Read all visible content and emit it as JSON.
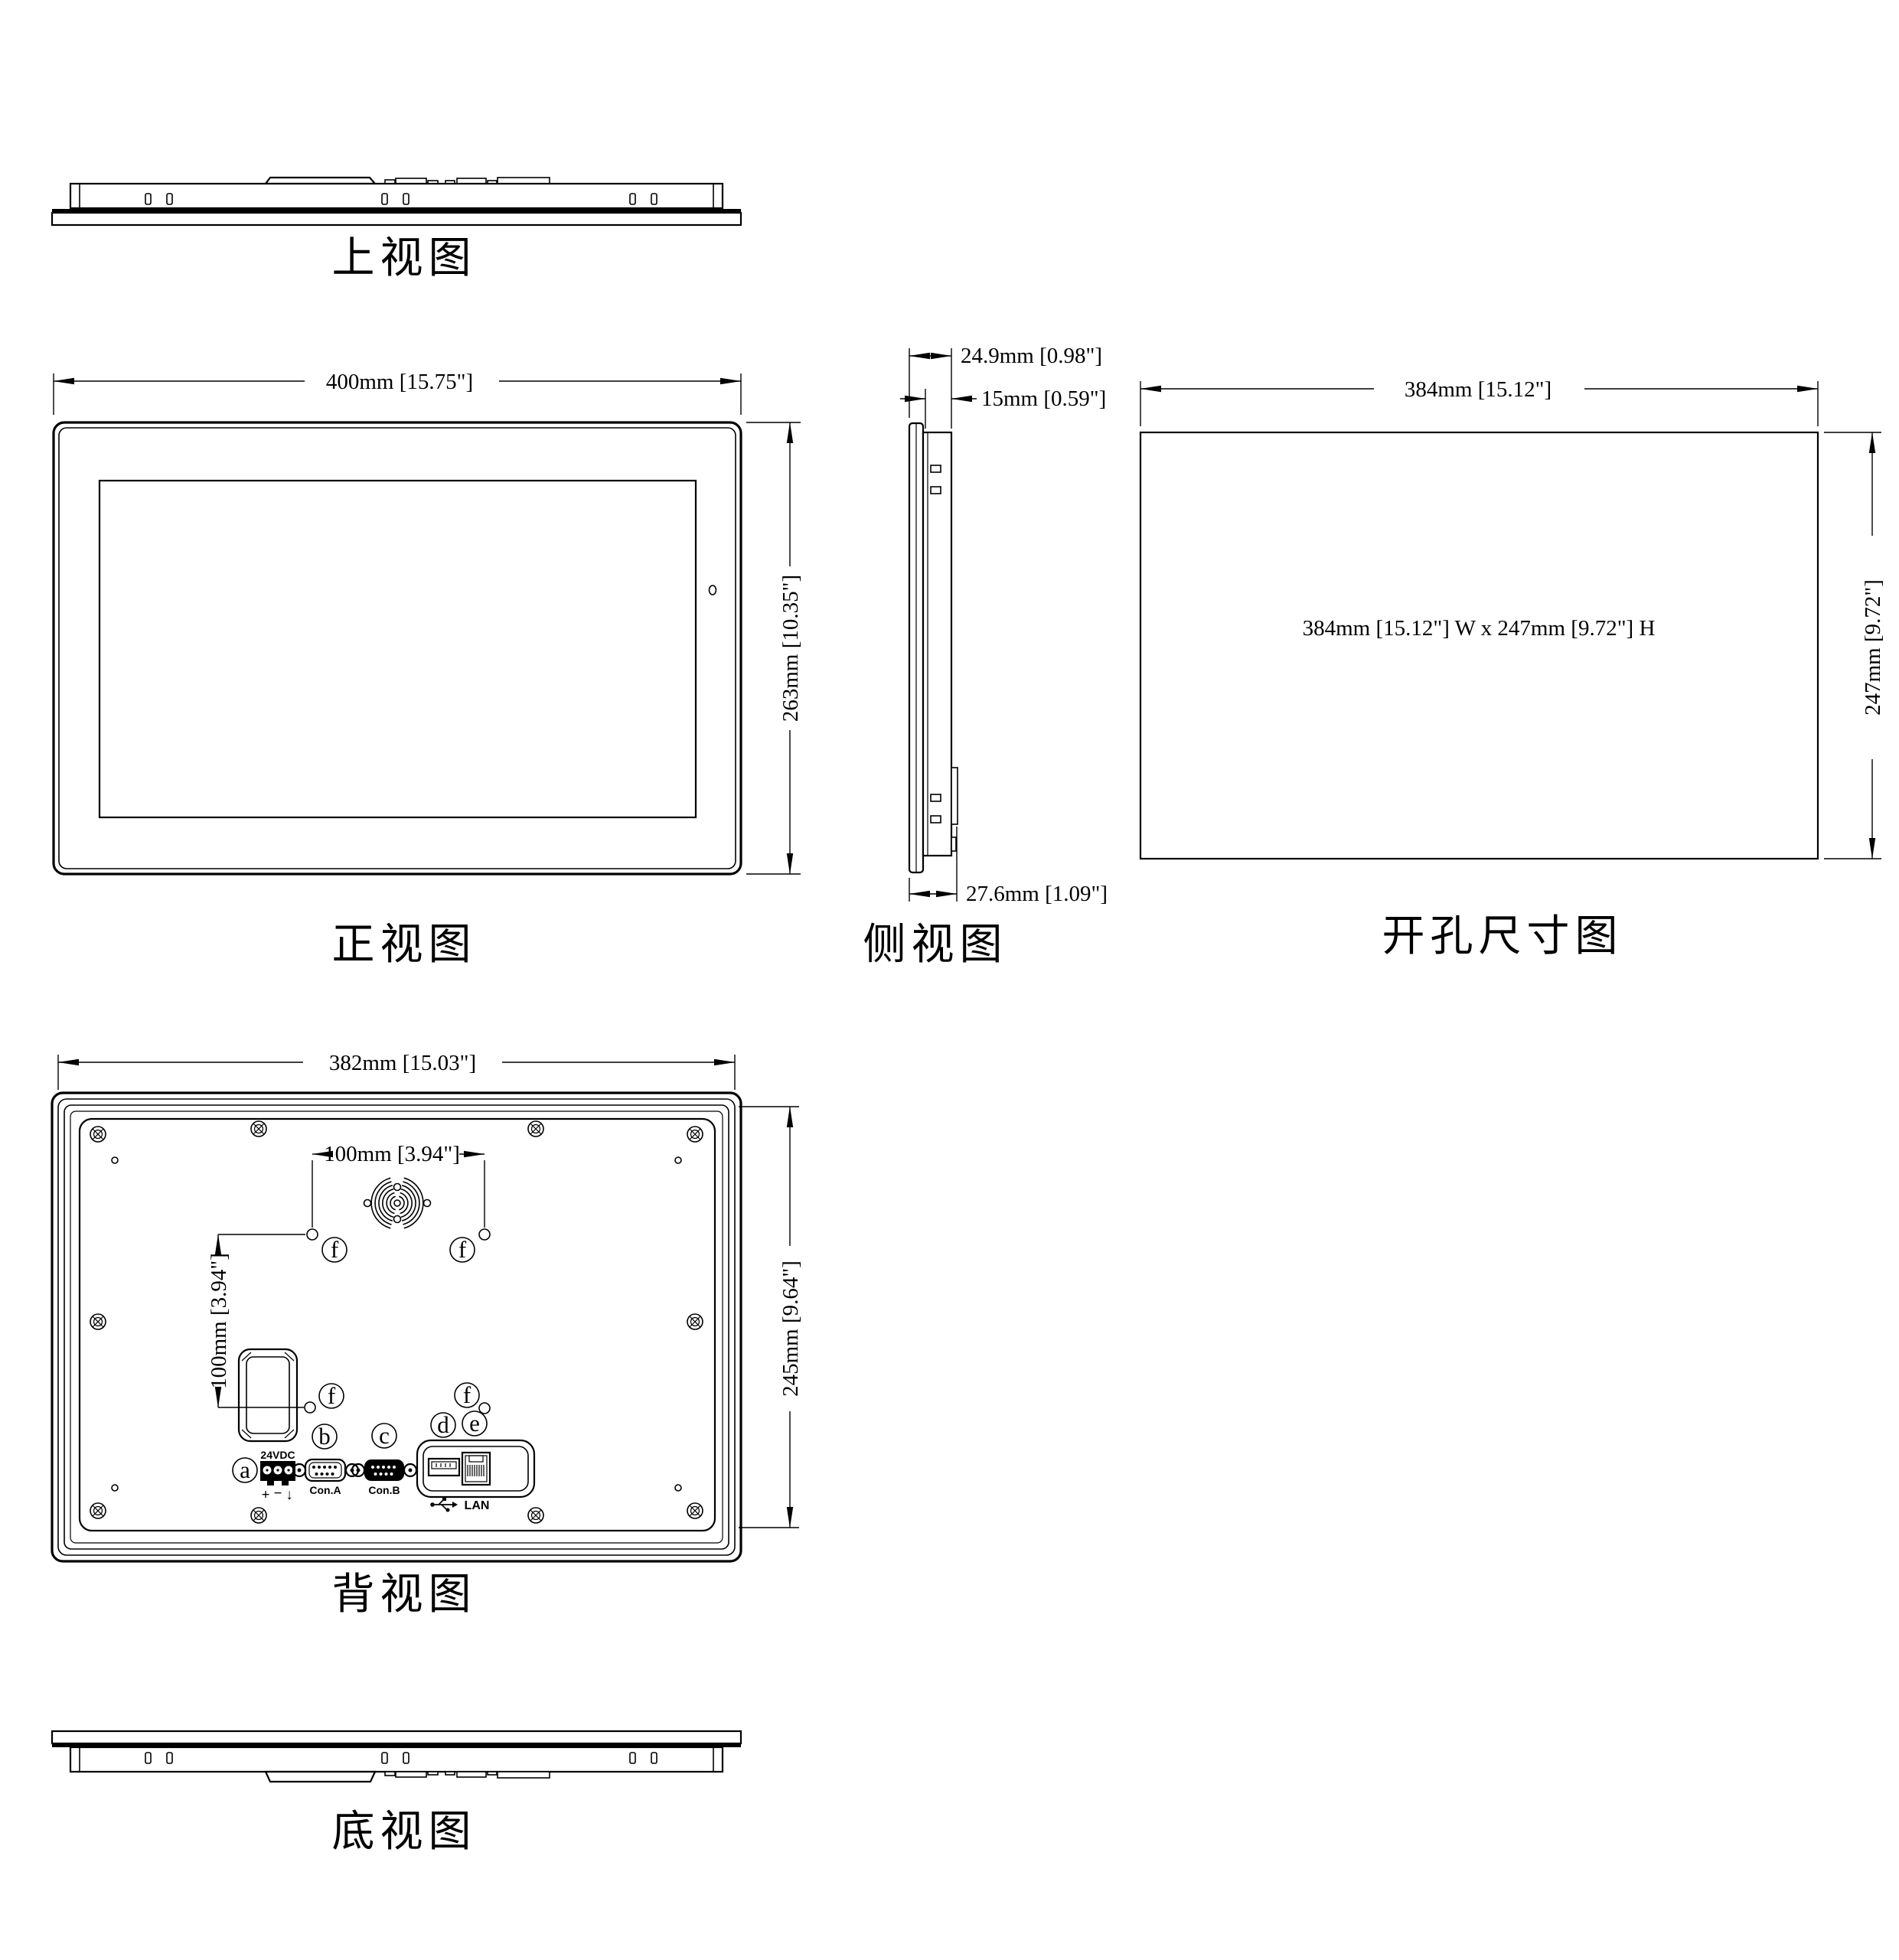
{
  "views": {
    "top": {
      "label": "上视图"
    },
    "front": {
      "label": "正视图",
      "width_dim": "400mm [15.75\"]",
      "height_dim": "263mm [10.35\"]"
    },
    "side": {
      "label": "侧视图",
      "depth_total_dim": "24.9mm [0.98\"]",
      "depth_front_dim": "15mm [0.59\"]",
      "depth_rear_dim": "27.6mm [1.09\"]"
    },
    "cutout": {
      "label": "开孔尺寸图",
      "width_dim": "384mm [15.12\"]",
      "height_dim": "247mm [9.72\"]",
      "note": "384mm [15.12\"] W x 247mm [9.72\"] H"
    },
    "back": {
      "label": "背视图",
      "width_dim": "382mm [15.03\"]",
      "height_dim": "245mm [9.64\"]",
      "vesa_width_dim": "100mm [3.94\"]",
      "vesa_height_dim": "100mm [3.94\"]",
      "power_label": "24VDC",
      "power_plus": "+",
      "power_minus": "−",
      "power_ground": "↓",
      "con_a_label": "Con.A",
      "con_b_label": "Con.B",
      "lan_label": "LAN",
      "callout_a": "a",
      "callout_b": "b",
      "callout_c": "c",
      "callout_d": "d",
      "callout_e": "e",
      "callout_f": "f"
    },
    "bottom": {
      "label": "底视图"
    }
  }
}
